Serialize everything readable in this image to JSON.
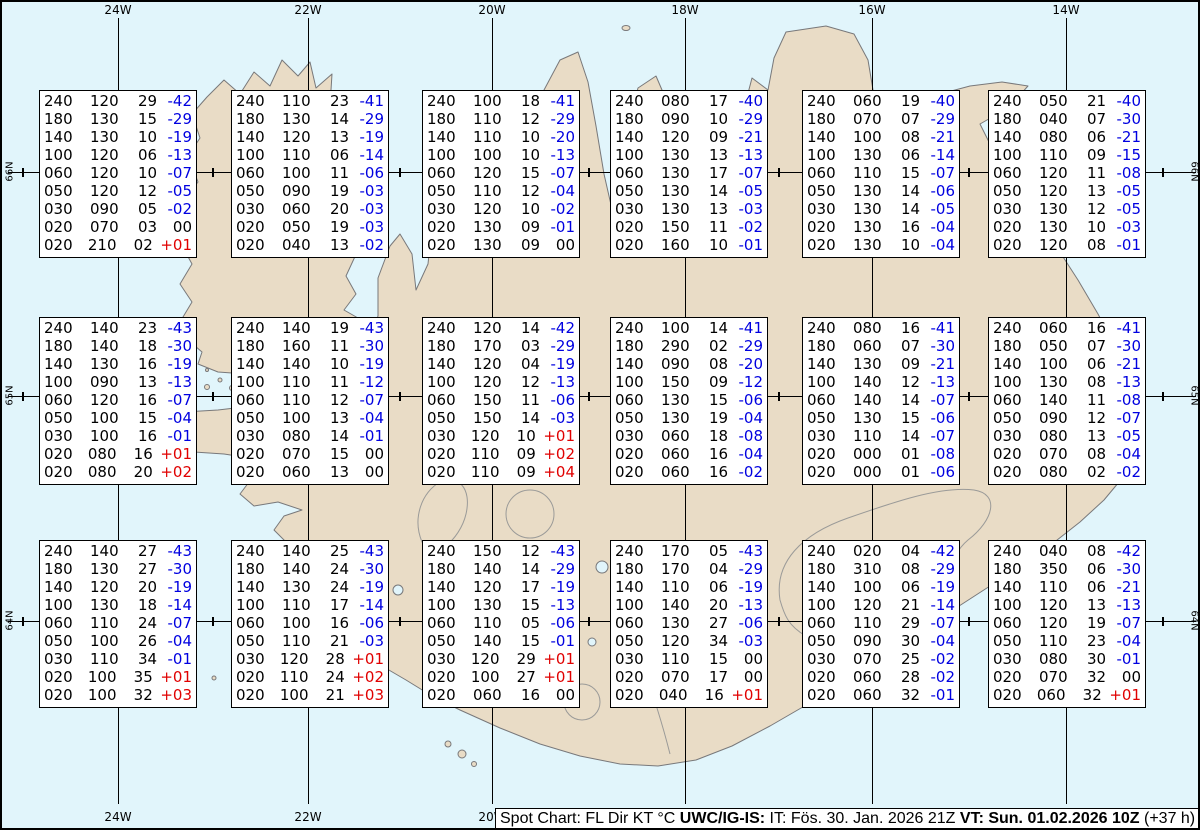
{
  "colors": {
    "sea": "#e1f5fb",
    "land": "#e9dcc6",
    "coast": "#78787a",
    "contour": "#9a9a98",
    "neg": "#0000e0",
    "pos": "#e00000",
    "zero": "#000000"
  },
  "grid": {
    "meridians": [
      {
        "label": "24W",
        "x": 116
      },
      {
        "label": "22W",
        "x": 306
      },
      {
        "label": "20W",
        "x": 490
      },
      {
        "label": "18W",
        "x": 683
      },
      {
        "label": "16W",
        "x": 870
      },
      {
        "label": "14W",
        "x": 1064
      }
    ],
    "parallels": [
      {
        "label": "66N",
        "y": 170
      },
      {
        "label": "65N",
        "y": 394
      },
      {
        "label": "64N",
        "y": 619
      }
    ],
    "minor_tick_xs": [
      21,
      211,
      398,
      587,
      777,
      967,
      1161
    ]
  },
  "status_bar": {
    "segments": [
      {
        "text": "Spot Chart: FL Dir KT °C ",
        "bold": false
      },
      {
        "text": "UWC/IG-IS:",
        "bold": true
      },
      {
        "text": " IT: Fös. 30. Jan. 2026 21Z ",
        "bold": false
      },
      {
        "text": "VT: Sun. 01.02.2026 10Z",
        "bold": true
      },
      {
        "text": " (+37 h)",
        "bold": false
      }
    ]
  },
  "spot_boxes": [
    {
      "x": 37,
      "y": 88,
      "rows": [
        [
          "240",
          "120",
          "29",
          "-42"
        ],
        [
          "180",
          "130",
          "15",
          "-29"
        ],
        [
          "140",
          "130",
          "10",
          "-19"
        ],
        [
          "100",
          "120",
          "06",
          "-13"
        ],
        [
          "060",
          "120",
          "10",
          "-07"
        ],
        [
          "050",
          "120",
          "12",
          "-05"
        ],
        [
          "030",
          "090",
          "05",
          "-02"
        ],
        [
          "020",
          "070",
          "03",
          "00"
        ],
        [
          "020",
          "210",
          "02",
          "+01"
        ]
      ]
    },
    {
      "x": 229,
      "y": 88,
      "rows": [
        [
          "240",
          "110",
          "23",
          "-41"
        ],
        [
          "180",
          "130",
          "14",
          "-29"
        ],
        [
          "140",
          "120",
          "13",
          "-19"
        ],
        [
          "100",
          "110",
          "06",
          "-14"
        ],
        [
          "060",
          "100",
          "11",
          "-06"
        ],
        [
          "050",
          "090",
          "19",
          "-03"
        ],
        [
          "030",
          "060",
          "20",
          "-03"
        ],
        [
          "020",
          "050",
          "19",
          "-03"
        ],
        [
          "020",
          "040",
          "13",
          "-02"
        ]
      ]
    },
    {
      "x": 420,
      "y": 88,
      "rows": [
        [
          "240",
          "100",
          "18",
          "-41"
        ],
        [
          "180",
          "110",
          "12",
          "-29"
        ],
        [
          "140",
          "110",
          "10",
          "-20"
        ],
        [
          "100",
          "100",
          "10",
          "-13"
        ],
        [
          "060",
          "120",
          "15",
          "-07"
        ],
        [
          "050",
          "110",
          "12",
          "-04"
        ],
        [
          "030",
          "120",
          "10",
          "-02"
        ],
        [
          "020",
          "130",
          "09",
          "-01"
        ],
        [
          "020",
          "130",
          "09",
          "00"
        ]
      ]
    },
    {
      "x": 608,
      "y": 88,
      "rows": [
        [
          "240",
          "080",
          "17",
          "-40"
        ],
        [
          "180",
          "090",
          "10",
          "-29"
        ],
        [
          "140",
          "120",
          "09",
          "-21"
        ],
        [
          "100",
          "130",
          "13",
          "-13"
        ],
        [
          "060",
          "130",
          "17",
          "-07"
        ],
        [
          "050",
          "130",
          "14",
          "-05"
        ],
        [
          "030",
          "130",
          "13",
          "-03"
        ],
        [
          "020",
          "150",
          "11",
          "-02"
        ],
        [
          "020",
          "160",
          "10",
          "-01"
        ]
      ]
    },
    {
      "x": 800,
      "y": 88,
      "rows": [
        [
          "240",
          "060",
          "19",
          "-40"
        ],
        [
          "180",
          "070",
          "07",
          "-29"
        ],
        [
          "140",
          "100",
          "08",
          "-21"
        ],
        [
          "100",
          "130",
          "06",
          "-14"
        ],
        [
          "060",
          "110",
          "15",
          "-07"
        ],
        [
          "050",
          "130",
          "14",
          "-06"
        ],
        [
          "030",
          "130",
          "14",
          "-05"
        ],
        [
          "020",
          "130",
          "16",
          "-04"
        ],
        [
          "020",
          "130",
          "10",
          "-04"
        ]
      ]
    },
    {
      "x": 986,
      "y": 88,
      "rows": [
        [
          "240",
          "050",
          "21",
          "-40"
        ],
        [
          "180",
          "040",
          "07",
          "-30"
        ],
        [
          "140",
          "080",
          "06",
          "-21"
        ],
        [
          "100",
          "110",
          "09",
          "-15"
        ],
        [
          "060",
          "120",
          "11",
          "-08"
        ],
        [
          "050",
          "120",
          "13",
          "-05"
        ],
        [
          "030",
          "130",
          "12",
          "-05"
        ],
        [
          "020",
          "130",
          "10",
          "-03"
        ],
        [
          "020",
          "120",
          "08",
          "-01"
        ]
      ]
    },
    {
      "x": 37,
      "y": 315,
      "rows": [
        [
          "240",
          "140",
          "23",
          "-43"
        ],
        [
          "180",
          "140",
          "18",
          "-30"
        ],
        [
          "140",
          "130",
          "16",
          "-19"
        ],
        [
          "100",
          "090",
          "13",
          "-13"
        ],
        [
          "060",
          "120",
          "16",
          "-07"
        ],
        [
          "050",
          "100",
          "15",
          "-04"
        ],
        [
          "030",
          "100",
          "16",
          "-01"
        ],
        [
          "020",
          "080",
          "16",
          "+01"
        ],
        [
          "020",
          "080",
          "20",
          "+02"
        ]
      ]
    },
    {
      "x": 229,
      "y": 315,
      "rows": [
        [
          "240",
          "140",
          "19",
          "-43"
        ],
        [
          "180",
          "160",
          "11",
          "-30"
        ],
        [
          "140",
          "140",
          "10",
          "-19"
        ],
        [
          "100",
          "110",
          "11",
          "-12"
        ],
        [
          "060",
          "110",
          "12",
          "-07"
        ],
        [
          "050",
          "100",
          "13",
          "-04"
        ],
        [
          "030",
          "080",
          "14",
          "-01"
        ],
        [
          "020",
          "070",
          "15",
          "00"
        ],
        [
          "020",
          "060",
          "13",
          "00"
        ]
      ]
    },
    {
      "x": 420,
      "y": 315,
      "rows": [
        [
          "240",
          "120",
          "14",
          "-42"
        ],
        [
          "180",
          "170",
          "03",
          "-29"
        ],
        [
          "140",
          "120",
          "04",
          "-19"
        ],
        [
          "100",
          "120",
          "12",
          "-13"
        ],
        [
          "060",
          "150",
          "11",
          "-06"
        ],
        [
          "050",
          "150",
          "14",
          "-03"
        ],
        [
          "030",
          "120",
          "10",
          "+01"
        ],
        [
          "020",
          "110",
          "09",
          "+02"
        ],
        [
          "020",
          "110",
          "09",
          "+04"
        ]
      ]
    },
    {
      "x": 608,
      "y": 315,
      "rows": [
        [
          "240",
          "100",
          "14",
          "-41"
        ],
        [
          "180",
          "290",
          "02",
          "-29"
        ],
        [
          "140",
          "090",
          "08",
          "-20"
        ],
        [
          "100",
          "150",
          "09",
          "-12"
        ],
        [
          "060",
          "130",
          "15",
          "-06"
        ],
        [
          "050",
          "130",
          "19",
          "-04"
        ],
        [
          "030",
          "060",
          "18",
          "-08"
        ],
        [
          "020",
          "060",
          "16",
          "-04"
        ],
        [
          "020",
          "060",
          "16",
          "-02"
        ]
      ]
    },
    {
      "x": 800,
      "y": 315,
      "rows": [
        [
          "240",
          "080",
          "16",
          "-41"
        ],
        [
          "180",
          "060",
          "07",
          "-30"
        ],
        [
          "140",
          "130",
          "09",
          "-21"
        ],
        [
          "100",
          "140",
          "12",
          "-13"
        ],
        [
          "060",
          "140",
          "14",
          "-07"
        ],
        [
          "050",
          "130",
          "15",
          "-06"
        ],
        [
          "030",
          "110",
          "14",
          "-07"
        ],
        [
          "020",
          "000",
          "01",
          "-08"
        ],
        [
          "020",
          "000",
          "01",
          "-06"
        ]
      ]
    },
    {
      "x": 986,
      "y": 315,
      "rows": [
        [
          "240",
          "060",
          "16",
          "-41"
        ],
        [
          "180",
          "050",
          "07",
          "-30"
        ],
        [
          "140",
          "100",
          "06",
          "-21"
        ],
        [
          "100",
          "130",
          "08",
          "-13"
        ],
        [
          "060",
          "140",
          "11",
          "-08"
        ],
        [
          "050",
          "090",
          "12",
          "-07"
        ],
        [
          "030",
          "080",
          "13",
          "-05"
        ],
        [
          "020",
          "070",
          "08",
          "-04"
        ],
        [
          "020",
          "080",
          "02",
          "-02"
        ]
      ]
    },
    {
      "x": 37,
      "y": 538,
      "rows": [
        [
          "240",
          "140",
          "27",
          "-43"
        ],
        [
          "180",
          "130",
          "27",
          "-30"
        ],
        [
          "140",
          "120",
          "20",
          "-19"
        ],
        [
          "100",
          "130",
          "18",
          "-14"
        ],
        [
          "060",
          "110",
          "24",
          "-07"
        ],
        [
          "050",
          "100",
          "26",
          "-04"
        ],
        [
          "030",
          "110",
          "34",
          "-01"
        ],
        [
          "020",
          "100",
          "35",
          "+01"
        ],
        [
          "020",
          "100",
          "32",
          "+03"
        ]
      ]
    },
    {
      "x": 229,
      "y": 538,
      "rows": [
        [
          "240",
          "140",
          "25",
          "-43"
        ],
        [
          "180",
          "140",
          "24",
          "-30"
        ],
        [
          "140",
          "130",
          "24",
          "-19"
        ],
        [
          "100",
          "110",
          "17",
          "-14"
        ],
        [
          "060",
          "100",
          "16",
          "-06"
        ],
        [
          "050",
          "110",
          "21",
          "-03"
        ],
        [
          "030",
          "120",
          "28",
          "+01"
        ],
        [
          "020",
          "110",
          "24",
          "+02"
        ],
        [
          "020",
          "100",
          "21",
          "+03"
        ]
      ]
    },
    {
      "x": 420,
      "y": 538,
      "rows": [
        [
          "240",
          "150",
          "12",
          "-43"
        ],
        [
          "180",
          "140",
          "14",
          "-29"
        ],
        [
          "140",
          "120",
          "17",
          "-19"
        ],
        [
          "100",
          "130",
          "15",
          "-13"
        ],
        [
          "060",
          "110",
          "05",
          "-06"
        ],
        [
          "050",
          "140",
          "15",
          "-01"
        ],
        [
          "030",
          "120",
          "29",
          "+01"
        ],
        [
          "020",
          "100",
          "27",
          "+01"
        ],
        [
          "020",
          "060",
          "16",
          "00"
        ]
      ]
    },
    {
      "x": 608,
      "y": 538,
      "rows": [
        [
          "240",
          "170",
          "05",
          "-43"
        ],
        [
          "180",
          "170",
          "04",
          "-29"
        ],
        [
          "140",
          "110",
          "06",
          "-19"
        ],
        [
          "100",
          "140",
          "20",
          "-13"
        ],
        [
          "060",
          "130",
          "27",
          "-06"
        ],
        [
          "050",
          "120",
          "34",
          "-03"
        ],
        [
          "030",
          "110",
          "15",
          "00"
        ],
        [
          "020",
          "070",
          "17",
          "00"
        ],
        [
          "020",
          "040",
          "16",
          "+01"
        ]
      ]
    },
    {
      "x": 800,
      "y": 538,
      "rows": [
        [
          "240",
          "020",
          "04",
          "-42"
        ],
        [
          "180",
          "310",
          "08",
          "-29"
        ],
        [
          "140",
          "100",
          "06",
          "-19"
        ],
        [
          "100",
          "120",
          "21",
          "-14"
        ],
        [
          "060",
          "110",
          "29",
          "-07"
        ],
        [
          "050",
          "090",
          "30",
          "-04"
        ],
        [
          "030",
          "070",
          "25",
          "-02"
        ],
        [
          "020",
          "060",
          "28",
          "-02"
        ],
        [
          "020",
          "060",
          "32",
          "-01"
        ]
      ]
    },
    {
      "x": 986,
      "y": 538,
      "rows": [
        [
          "240",
          "040",
          "08",
          "-42"
        ],
        [
          "180",
          "350",
          "06",
          "-30"
        ],
        [
          "140",
          "110",
          "06",
          "-21"
        ],
        [
          "100",
          "120",
          "13",
          "-13"
        ],
        [
          "060",
          "120",
          "19",
          "-07"
        ],
        [
          "050",
          "110",
          "23",
          "-04"
        ],
        [
          "030",
          "080",
          "30",
          "-01"
        ],
        [
          "020",
          "070",
          "32",
          "00"
        ],
        [
          "020",
          "060",
          "32",
          "+01"
        ]
      ]
    }
  ]
}
